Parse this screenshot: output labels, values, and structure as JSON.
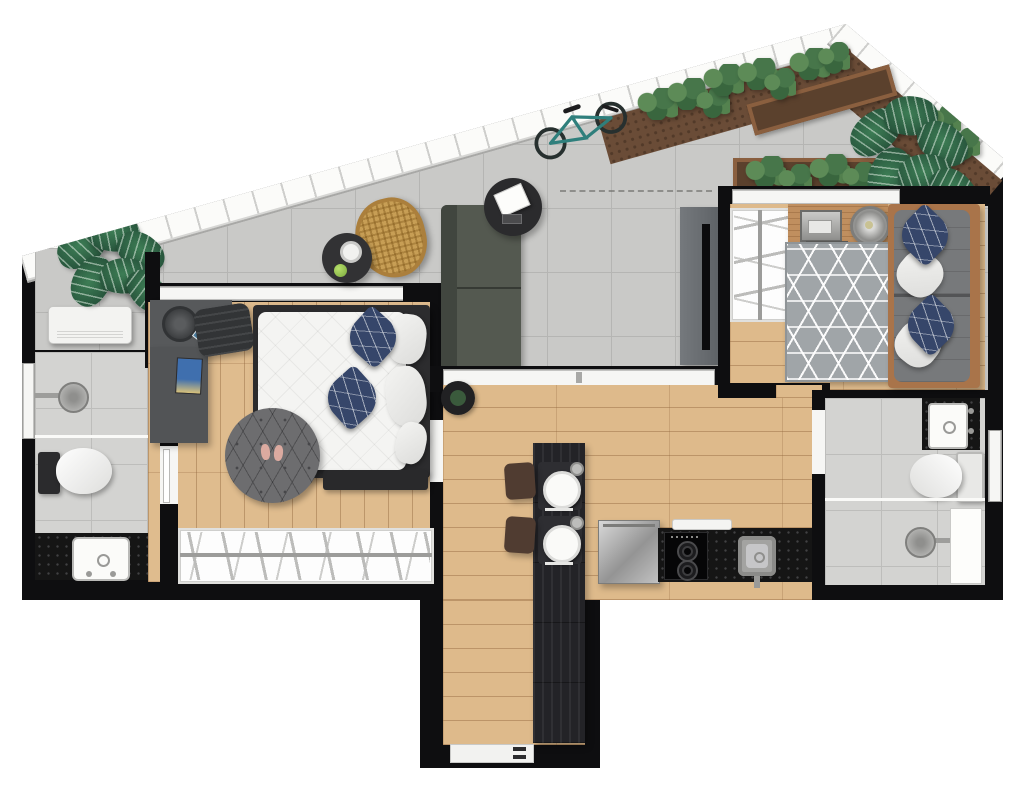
{
  "meta": {
    "kind": "residential-floor-plan",
    "view": "top-down-render",
    "canvas": "1024x796",
    "visible_text": "none"
  },
  "palette": {
    "background": "#ffffff",
    "walls": "#0e0e10",
    "roof_eave_band": "#fbfbf9",
    "terrace_tile": "#c9c9c7",
    "tile_grout": "#b5b5b3",
    "bathroom_tile": "#d3d3d1",
    "wood_floor": "#deba8b",
    "wood_seam": "#92673e",
    "island_wood": "#232327",
    "granite_counter": "#151515",
    "stainless": "#b9b9b9",
    "duvet_white": "#f4f4f2",
    "pillow_navy": "#36466a",
    "terrace_sofa": "#545950",
    "bedroom2_sofa": "#77797b",
    "sofa_wood_frame": "#a9744a",
    "rug_round_dark": "#6d6d6f",
    "rug_cube_gray": "#a0a5a8",
    "desk_gray": "#57595b",
    "desk_wood": "#c08f5f",
    "rattan_chair": "#c79e55",
    "soil": "#6a4c37",
    "shrub_green": "#47764a",
    "monstera_green": "#28563d",
    "bicycle_teal": "#2f7f7c",
    "accent_black_furniture": "#2b2b2d"
  },
  "rooms": [
    {
      "name": "terrace",
      "floor": "concrete-tile",
      "items": [
        "monstera-plant-left",
        "ac-condenser-unit",
        "rattan-armchair",
        "side-table",
        "coffee-cup",
        "green-apple",
        "bicycle",
        "outdoor-sofa",
        "round-coffee-table",
        "laptop",
        "remote",
        "tv-panel",
        "roof-garden-soil",
        "planter-boxes",
        "shrubs",
        "monstera-plant-right",
        "dashed-roof-projection-line"
      ]
    },
    {
      "name": "bedroom-1",
      "floor": "wood-planks-vertical",
      "items": [
        "sliding-window-wall",
        "l-shaped-desk",
        "desk-bowl",
        "smartphone",
        "magazine",
        "office-chair",
        "double-bed",
        "navy-pillows",
        "white-pillows",
        "foot-bench",
        "round-rug",
        "slippers",
        "clothes-rack-hangers"
      ]
    },
    {
      "name": "bathroom-1",
      "floor": "tile",
      "items": [
        "left-wall-window",
        "shower-head",
        "shower-divider",
        "toilet",
        "black-vanity-counter",
        "white-sink"
      ]
    },
    {
      "name": "living-kitchen",
      "floor": "wood-planks-horizontal",
      "items": [
        "sliding-door-wall",
        "potted-plant",
        "kitchen-island",
        "placemats",
        "dinner-plates",
        "cutlery",
        "glasses",
        "stools",
        "stainless-appliance",
        "dish-shelf",
        "cooktop-two-burners",
        "granite-counter",
        "kitchen-sink",
        "entry-hall-wardrobe",
        "entry-door-threshold"
      ]
    },
    {
      "name": "bedroom-2",
      "floor": "wood-planks-horizontal",
      "items": [
        "window-wall",
        "clothes-rack-hangers",
        "wood-desk",
        "typewriter-laptop",
        "metal-bowl",
        "tufted-stool",
        "cube-pattern-rug",
        "sofa-with-wood-frame",
        "navy-pillows",
        "gray-pillows",
        "door-opening"
      ]
    },
    {
      "name": "bathroom-2",
      "floor": "tile",
      "items": [
        "black-sink-unit",
        "white-sink",
        "toilet",
        "shower-divider",
        "shower-head",
        "shower-niche",
        "right-wall-window",
        "door-opening"
      ]
    }
  ]
}
